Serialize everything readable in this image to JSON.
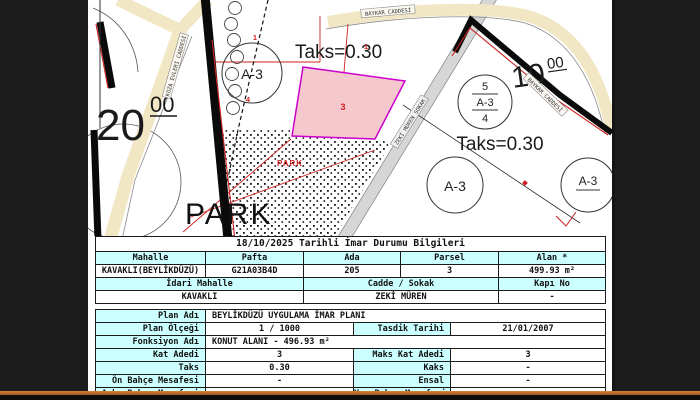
{
  "map": {
    "streets": {
      "top": "BAYKAR CADDESİ",
      "right": "BAYKAR CADDESİ",
      "diagonal": "ZEKİ MÜREN SOKAK",
      "left": "KOZA EVLERİ CADDESİ"
    },
    "labels": {
      "taks1": "Taks=0.30",
      "taks2": "Taks=0.30",
      "park_large": "PARK",
      "park_small": "PARK",
      "zone1": "A-3",
      "zone3": "A-3",
      "zone4": "A-3",
      "fraction": {
        "top": "5",
        "mid": "A-3",
        "bottom": "4"
      },
      "dim20": {
        "main": "20",
        "sup": "00"
      },
      "dim10": {
        "main": "10",
        "sup": "00"
      },
      "num1": "1",
      "num1b": "1",
      "num3": "3",
      "num4": "4"
    },
    "colors": {
      "road_yellow": "#f2e7c4",
      "road_gray": "#d6d6d6",
      "parcel_pink": "#f5c8ce",
      "parcel_border": "#cc00cc",
      "line_red": "#cc2222",
      "label_cyan": "#ccffff"
    }
  },
  "table1": {
    "title": "18/10/2025 Tarihli İmar Durumu Bilgileri",
    "headers": [
      "Mahalle",
      "Pafta",
      "Ada",
      "Parsel",
      "Alan *"
    ],
    "values": [
      "KAVAKLI(BEYLİKDÜZÜ)",
      "G21A03B4D",
      "205",
      "3",
      "499.93 m²"
    ],
    "headers2": [
      "İdari Mahalle",
      "Cadde / Sokak",
      "Kapı No"
    ],
    "values2": [
      "KAVAKLI",
      "ZEKİ MÜREN",
      "-"
    ]
  },
  "table2": {
    "rows": [
      {
        "label": "Plan Adı",
        "value": "BEYLİKDÜZÜ UYGULAMA İMAR PLANI"
      },
      {
        "label": "Plan Ölçeği",
        "value": "1 / 1000",
        "label2": "Tasdik Tarihi",
        "value2": "21/01/2007"
      },
      {
        "label": "Fonksiyon Adı",
        "value": "KONUT ALANI - 496.93 m²"
      },
      {
        "label": "Kat Adedi",
        "value": "3",
        "label2": "Maks Kat Adedi",
        "value2": "3"
      },
      {
        "label": "Taks",
        "value": "0.30",
        "label2": "Kaks",
        "value2": "-"
      },
      {
        "label": "Ön Bahçe Mesafesi",
        "value": "-",
        "label2": "Ensal",
        "value2": "-"
      },
      {
        "label": "Arka Bahçe Mesafesi",
        "value": "-",
        "label2": "Yan Bahçe Mesafesi",
        "value2": "-"
      }
    ]
  }
}
